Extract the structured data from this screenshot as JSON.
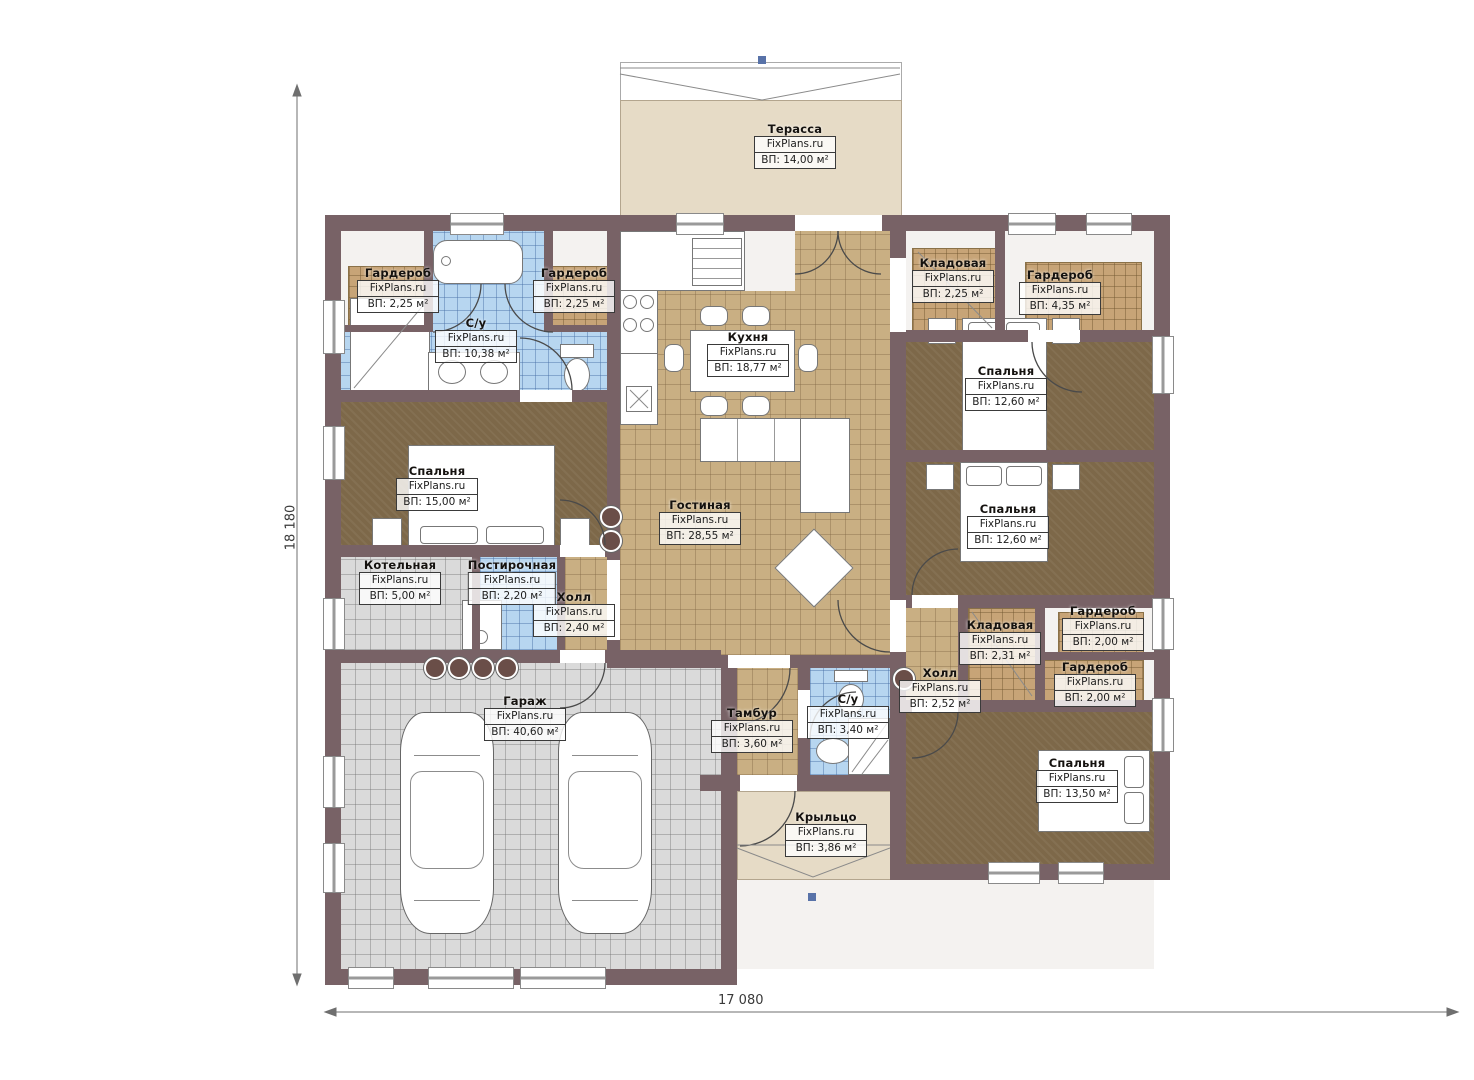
{
  "brand": "FixPlans.ru",
  "dimensions": {
    "height_label": "18 180",
    "width_label": "17 080"
  },
  "colors": {
    "wall": "#786266",
    "floor_tile": "#c9af83",
    "floor_bedroom": "#7d6849",
    "floor_bath": "#b7d6f0",
    "floor_garage": "#dadada",
    "floor_terrace": "#e6dbc6",
    "marker_blue": "#5872a8"
  },
  "rooms": {
    "terrace": {
      "name": "Терасса",
      "area": "ВП: 14,00 м²"
    },
    "wardrobe_tl": {
      "name": "Гардероб",
      "area": "ВП: 2,25 м²"
    },
    "bathroom_main": {
      "name": "С/у",
      "area": "ВП: 10,38 м²"
    },
    "wardrobe_tl2": {
      "name": "Гардероб",
      "area": "ВП: 2,25 м²"
    },
    "kitchen": {
      "name": "Кухня",
      "area": "ВП: 18,77 м²"
    },
    "pantry_tr": {
      "name": "Кладовая",
      "area": "ВП: 2,25 м²"
    },
    "wardrobe_tr": {
      "name": "Гардероб",
      "area": "ВП: 4,35 м²"
    },
    "bedroom_tr": {
      "name": "Спальня",
      "area": "ВП: 12,60 м²"
    },
    "bedroom_left": {
      "name": "Спальня",
      "area": "ВП: 15,00 м²"
    },
    "living": {
      "name": "Гостиная",
      "area": "ВП: 28,55 м²"
    },
    "bedroom_mr": {
      "name": "Спальня",
      "area": "ВП: 12,60 м²"
    },
    "boiler": {
      "name": "Котельная",
      "area": "ВП: 5,00 м²"
    },
    "laundry": {
      "name": "Постирочная",
      "area": "ВП: 2,20 м²"
    },
    "hall_left": {
      "name": "Холл",
      "area": "ВП: 2,40 м²"
    },
    "garage": {
      "name": "Гараж",
      "area": "ВП: 40,60 м²"
    },
    "tambour": {
      "name": "Тамбур",
      "area": "ВП: 3,60 м²"
    },
    "bathroom_small": {
      "name": "С/у",
      "area": "ВП: 3,40 м²"
    },
    "hall_right": {
      "name": "Холл",
      "area": "ВП: 2,52 м²"
    },
    "pantry_right": {
      "name": "Кладовая",
      "area": "ВП: 2,31 м²"
    },
    "wardrobe_r1": {
      "name": "Гардероб",
      "area": "ВП: 2,00 м²"
    },
    "wardrobe_r2": {
      "name": "Гардероб",
      "area": "ВП: 2,00 м²"
    },
    "bedroom_br": {
      "name": "Спальня",
      "area": "ВП: 13,50 м²"
    },
    "porch": {
      "name": "Крыльцо",
      "area": "ВП: 3,86 м²"
    }
  }
}
